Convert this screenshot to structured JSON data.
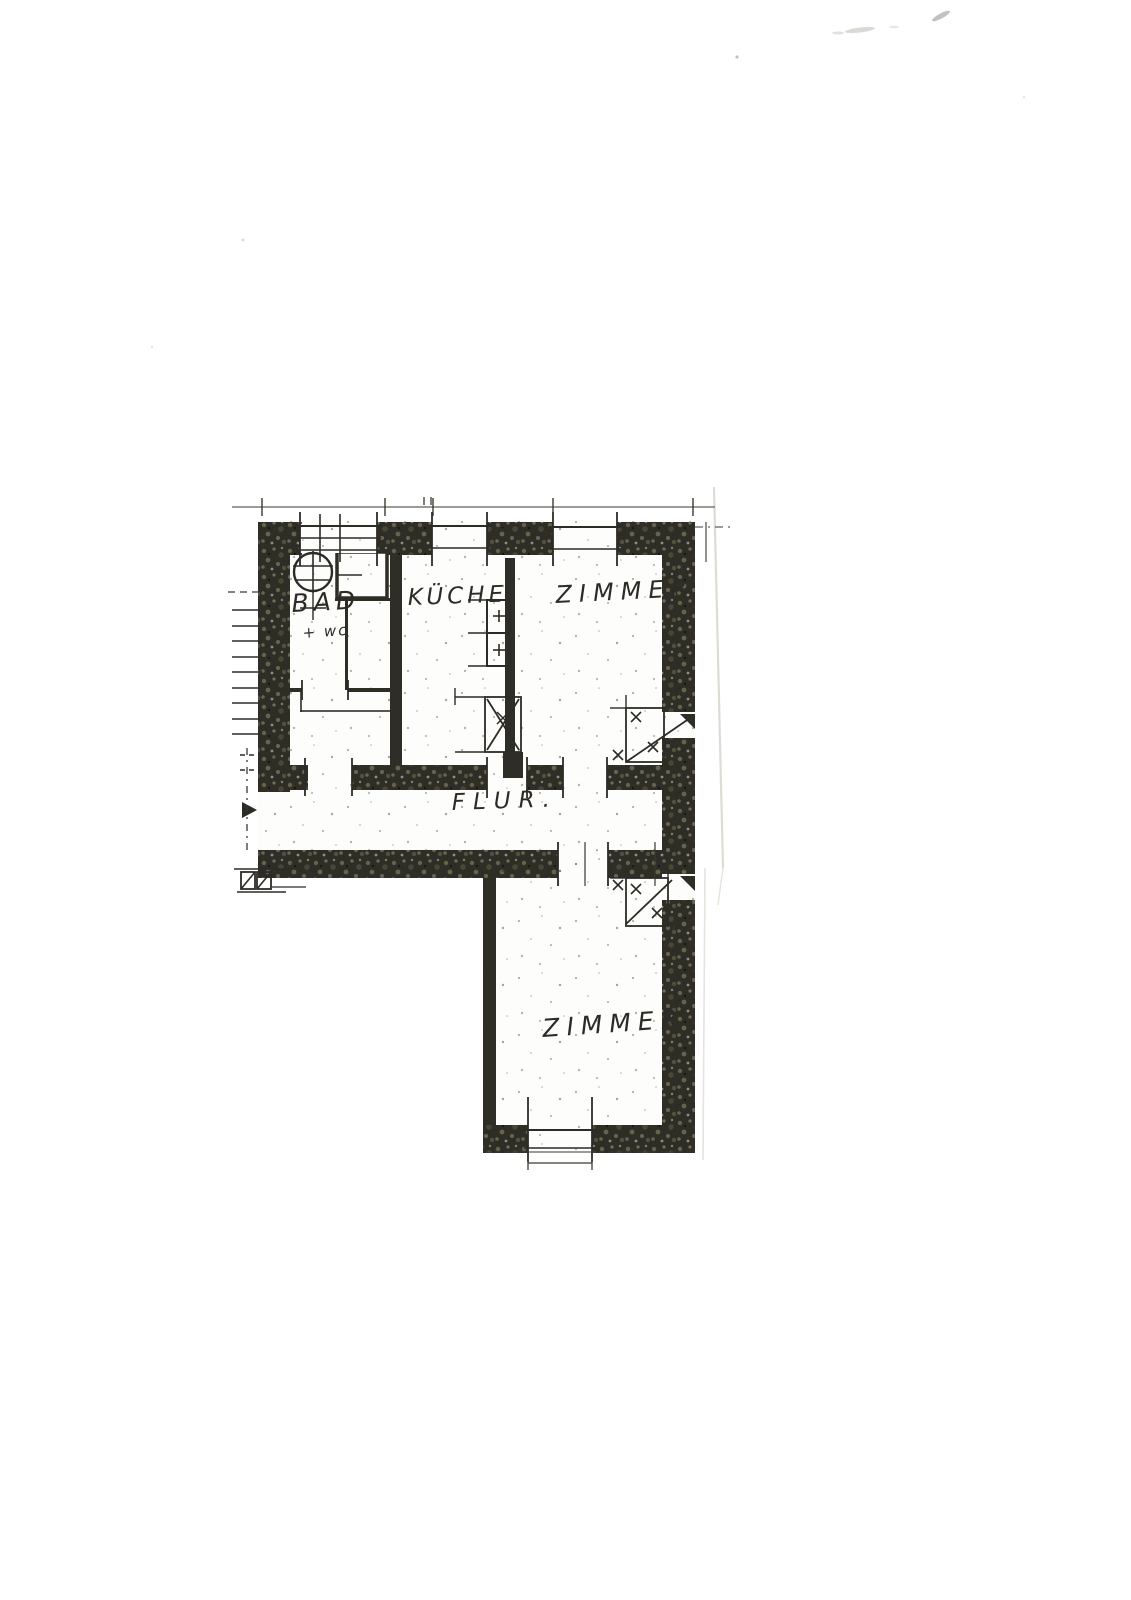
{
  "document": {
    "kind": "scanned-floor-plan",
    "rooms": [
      {
        "id": "bad",
        "label": "BAD",
        "sublabel": "+ wc"
      },
      {
        "id": "kueche",
        "label": "KÜCHE"
      },
      {
        "id": "zimmer_top",
        "label": "ZIMMER"
      },
      {
        "id": "flur",
        "label": "FLUR."
      },
      {
        "id": "zimmer_bottom",
        "label": "ZIMMER"
      }
    ],
    "symbols": [
      "entrance-arrow-icon",
      "washbasin-icon",
      "kitchen-counter-icon",
      "stove-icon",
      "tiled-stove-icon",
      "window-opening",
      "door-opening",
      "stair-tick-marks"
    ],
    "colors": {
      "paper": "#ffffff",
      "ink": "#2c2b26",
      "wall_dark": "#2e2d26",
      "wall_olive": "#6e6c50",
      "crease": "#dcdcd4"
    }
  }
}
